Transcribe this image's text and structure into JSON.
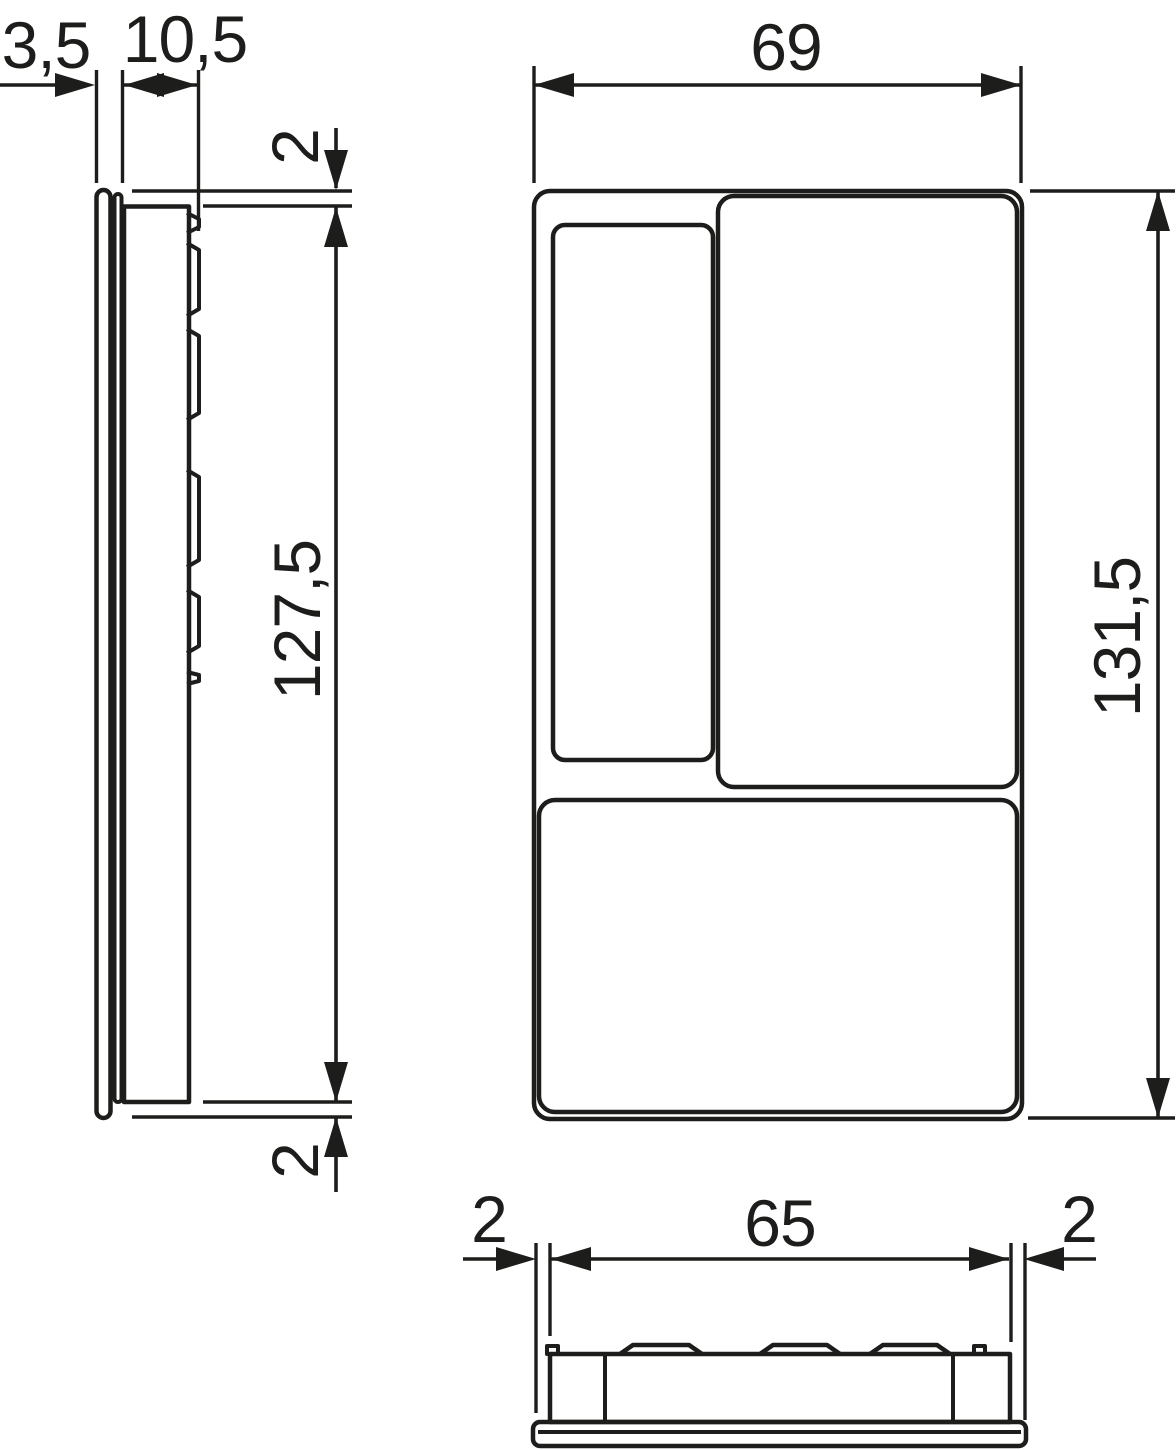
{
  "drawing": {
    "background_color": "#ffffff",
    "line_color": "#1d1d1b",
    "type": "technical-dimension-drawing",
    "views": {
      "side": {
        "dim_front_thickness": "3,5",
        "dim_body_depth": "10,5",
        "dim_top_offset": "2",
        "dim_body_height": "127,5",
        "dim_bottom_offset": "2"
      },
      "front": {
        "dim_width": "69",
        "dim_height": "131,5"
      },
      "bottom": {
        "dim_left_offset": "2",
        "dim_body_width": "65",
        "dim_right_offset": "2"
      }
    }
  }
}
